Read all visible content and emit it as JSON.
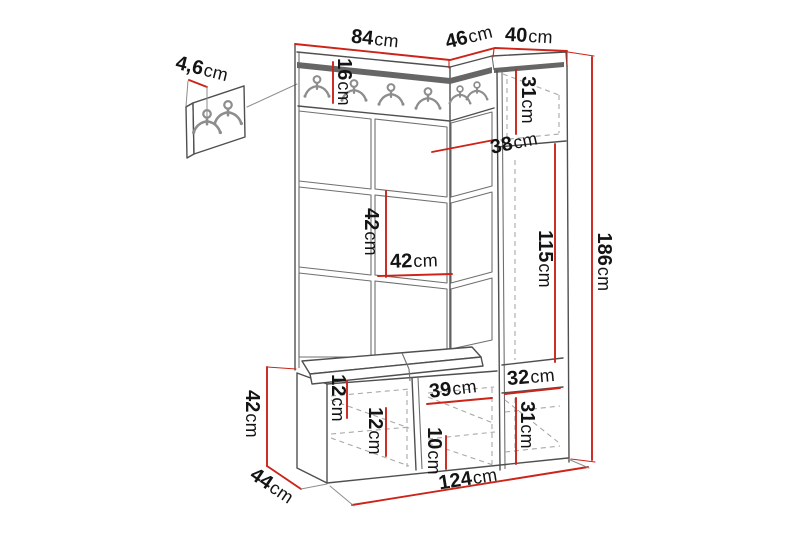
{
  "colors": {
    "background": "#ffffff",
    "dimension_line": "#cc2418",
    "outline": "#4f4f4f",
    "dashed_line": "#a8a8a8",
    "rail_strip": "#666666",
    "hook": "#8d8d8d",
    "label_text": "#141414"
  },
  "icons": {
    "coat_hook": "double-coat-hook-icon"
  },
  "dimensions": {
    "panel_thickness": {
      "value": "4,6",
      "unit": "cm"
    },
    "top_width_left": {
      "value": "84",
      "unit": "cm"
    },
    "top_depth_corner": {
      "value": "46",
      "unit": "cm"
    },
    "top_width_right": {
      "value": "40",
      "unit": "cm"
    },
    "rail_height": {
      "value": "16",
      "unit": "cm"
    },
    "cabinet_top_section": {
      "value": "31",
      "unit": "cm"
    },
    "cabinet_depth": {
      "value": "38",
      "unit": "cm"
    },
    "cabinet_mid_section": {
      "value": "115",
      "unit": "cm"
    },
    "total_height": {
      "value": "186",
      "unit": "cm"
    },
    "panel_row_height": {
      "value": "42",
      "unit": "cm"
    },
    "panel_col_width": {
      "value": "42",
      "unit": "cm"
    },
    "cabinet_inner_width": {
      "value": "32",
      "unit": "cm"
    },
    "cabinet_bottom_section": {
      "value": "31",
      "unit": "cm"
    },
    "bench_top_section": {
      "value": "12",
      "unit": "cm"
    },
    "bench_shelf_a": {
      "value": "12",
      "unit": "cm"
    },
    "bench_compartment_width": {
      "value": "39",
      "unit": "cm"
    },
    "bench_shelf_b": {
      "value": "10",
      "unit": "cm"
    },
    "bench_height": {
      "value": "42",
      "unit": "cm"
    },
    "bench_depth": {
      "value": "44",
      "unit": "cm"
    },
    "total_width": {
      "value": "124",
      "unit": "cm"
    }
  }
}
